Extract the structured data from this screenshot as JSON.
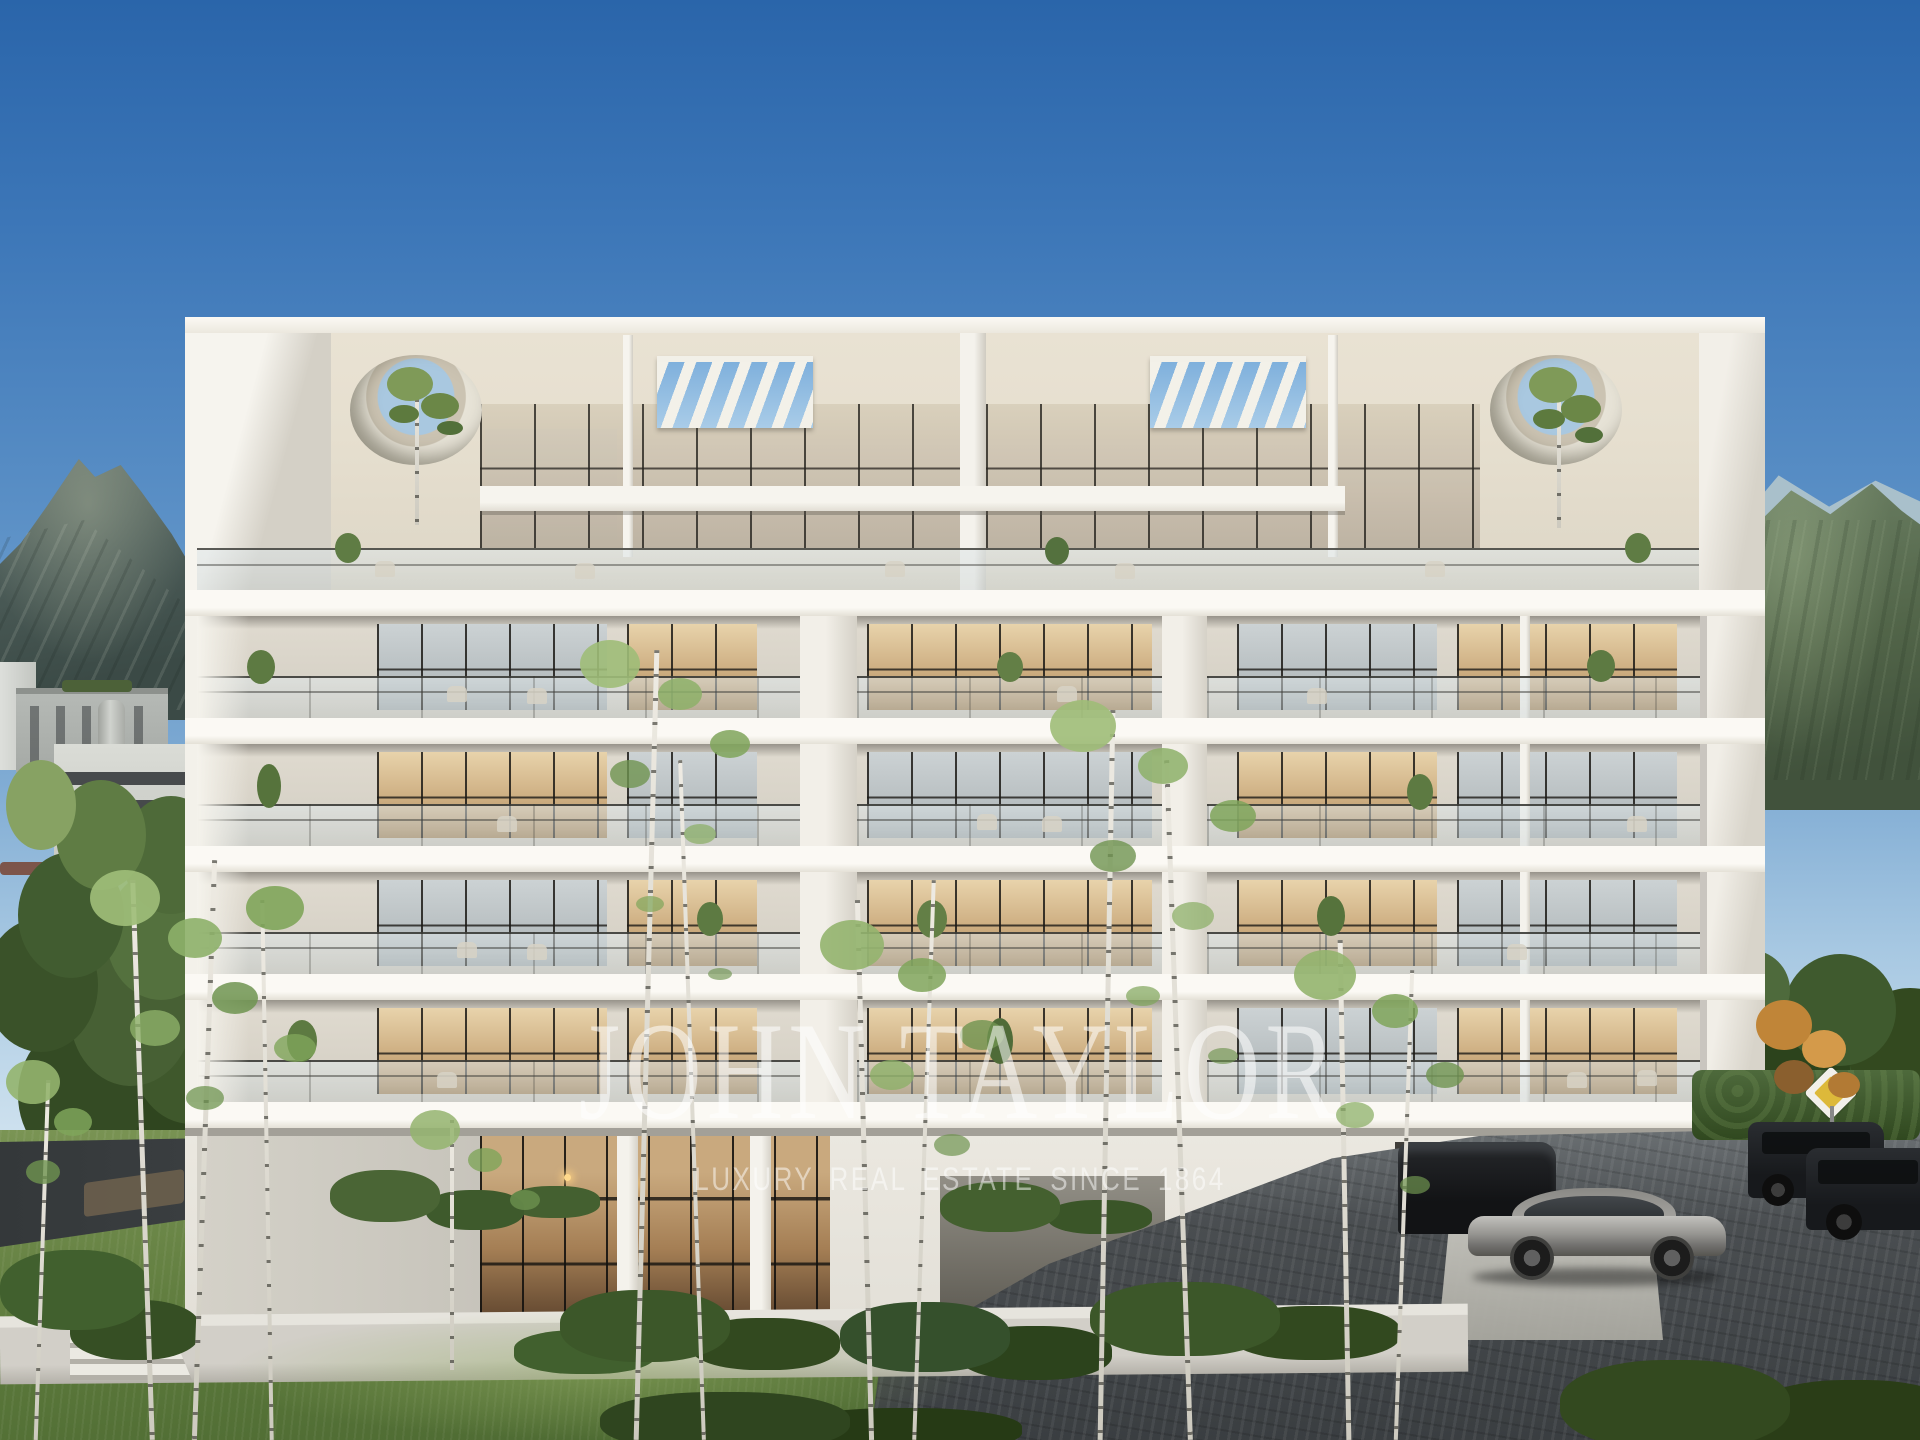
{
  "watermark": {
    "brand": "JOHN TAYLOR",
    "tagline": "LUXURY REAL ESTATE SINCE 1864"
  },
  "scene": {
    "type": "architectural-rendering",
    "description": "Modern six-level white apartment residence with glass balustrade balconies, rooftop pergola slats, circular roof openings with trees, birch trees and lawn in the foreground, mountains and neighbouring buildings behind, clear blue sky",
    "elements": [
      "blue-sky",
      "left-mountain",
      "right-mountain",
      "neighbourhood-buildings",
      "white-residence",
      "rooftop-pergolas",
      "circular-roof-openings",
      "glass-balcony-railings",
      "balcony-plants",
      "outdoor-furniture",
      "double-height-lobby",
      "garage-entrance",
      "silver-coupe",
      "dark-suv",
      "dark-wagon",
      "paved-driveway",
      "priority-road-sign",
      "hedge",
      "birch-trees",
      "lawn",
      "concrete-steps",
      "retaining-wall"
    ]
  },
  "palette": {
    "sky-top": "#2a65aa",
    "sky-horizon": "#dbe9f2",
    "building-white": "#f5f3ec",
    "slab-shadow": "#b8b4aa",
    "interior-warm": "#cbab7e",
    "glass-cool": "#c3cbcd",
    "mountain-left": "#4c5c58",
    "mountain-right": "#526549",
    "lawn-green": "#5d7a3c",
    "pavement-dark": "#43474a",
    "sign-yellow": "#ddb93a",
    "car-silver": "#969591",
    "car-dark": "#17191c"
  }
}
